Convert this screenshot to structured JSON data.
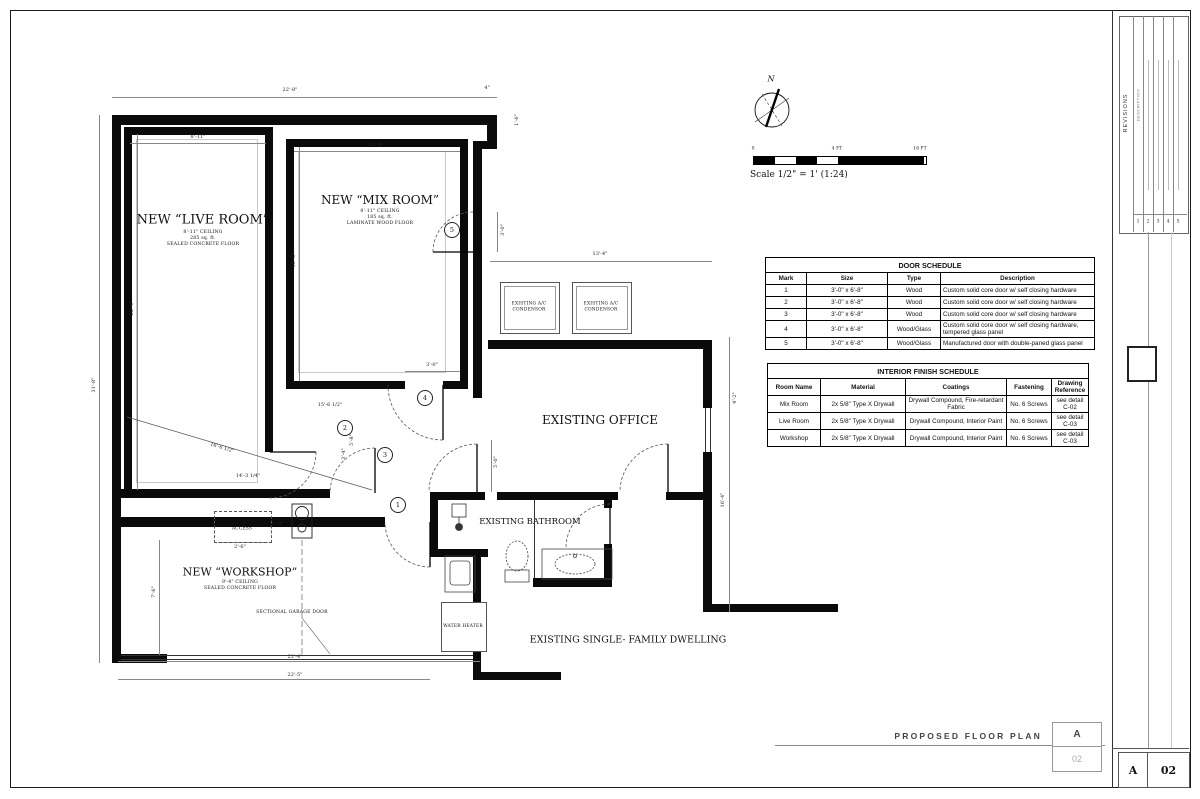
{
  "sheet": {
    "drawing_title": "PROPOSED FLOOR PLAN",
    "title_box": {
      "letter": "A",
      "number": "02"
    },
    "corner_box": {
      "letter": "A",
      "number": "02"
    },
    "north_label": "N",
    "scale_note": "Scale 1/2\" = 1' (1:24)",
    "scale_ticks": {
      "zero": "0",
      "mid": "4 FT",
      "end": "16 FT"
    }
  },
  "rooms": {
    "live": {
      "name": "NEW “LIVE ROOM”",
      "line1": "8'-11\" CEILING",
      "line2": "285 sq. ft.",
      "line3": "SEALED CONCRETE FLOOR"
    },
    "mix": {
      "name": "NEW “MIX ROOM”",
      "line1": "8'-11\" CEILING",
      "line2": "185 sq. ft.",
      "line3": "LAMINATE WOOD FLOOR"
    },
    "workshop": {
      "name": "NEW “WORKSHOP”",
      "line1": "9'-4\" CEILING",
      "line2": "SEALED CONCRETE FLOOR"
    },
    "office": "EXISTING OFFICE",
    "bathroom": "EXISTING BATHROOM",
    "dwelling": "EXISTING SINGLE- FAMILY DWELLING"
  },
  "equipment": {
    "ac1": "EXISTING A/C CONDENSOR",
    "ac2": "EXISTING A/C CONDENSOR",
    "water_heater": "WATER HEATER",
    "attic": "NEW ATTIC ACCESS",
    "garage_door": "SECTIONAL GARAGE DOOR"
  },
  "door_tags": [
    "1",
    "2",
    "3",
    "4",
    "5"
  ],
  "dims": {
    "overall_top": "22'-8\"",
    "jog": "4\"",
    "jog_side": "1'-6\"",
    "live_width": "8'-11\"",
    "mix_width": "13'-0\"",
    "overall_left": "31'-8\"",
    "live_height": "22'-4\"",
    "mix_height": "15'-6\"",
    "workshop_left": "7'-6\"",
    "office_top": "13'-4\"",
    "right_upper": "4'-2\"",
    "right_lower": "16'-4\"",
    "door4": "3'-0\"",
    "door5": "3'-0\"",
    "hall": "5'-0\"",
    "diagonal": "16'-6 1/2\"",
    "interior_a": "15'-6 1/2\"",
    "interior_b": "14'-3 1/4\"",
    "door2_a": "5'-8\"",
    "door2_b": "3'-4\"",
    "attic_width": "2'-6\"",
    "attic_offset": "10'-0\"",
    "overall_bottom": "22'-4\"",
    "garage_width": "22'-5\""
  },
  "door_schedule": {
    "title": "DOOR SCHEDULE",
    "headers": [
      "Mark",
      "Size",
      "Type",
      "Description"
    ],
    "rows": [
      [
        "1",
        "3'-0\" x 6'-8\"",
        "Wood",
        "Custom solid core door w/ self closing hardware"
      ],
      [
        "2",
        "3'-0\" x 6'-8\"",
        "Wood",
        "Custom solid core door w/ self closing hardware"
      ],
      [
        "3",
        "3'-0\" x 6'-8\"",
        "Wood",
        "Custom solid core door w/ self closing hardware"
      ],
      [
        "4",
        "3'-0\" x 6'-8\"",
        "Wood/Glass",
        "Custom solid core door w/ self closing hardware, tempered glass panel"
      ],
      [
        "5",
        "3'-0\" x 6'-8\"",
        "Wood/Glass",
        "Manufactured door with double-paned glass panel"
      ]
    ]
  },
  "finish_schedule": {
    "title": "INTERIOR FINISH SCHEDULE",
    "headers": [
      "Room Name",
      "Material",
      "Coatings",
      "Fastening",
      "Drawing Reference"
    ],
    "rows": [
      [
        "Mix Room",
        "2x 5/8\" Type X Drywall",
        "Drywall Compound, Fire-retardant Fabric",
        "No. 6 Screws",
        "see detail C-02"
      ],
      [
        "Live Room",
        "2x 5/8\" Type X Drywall",
        "Drywall Compound, Interior Paint",
        "No. 6 Screws",
        "see detail C-03"
      ],
      [
        "Workshop",
        "2x 5/8\" Type X Drywall",
        "Drywall Compound, Interior Paint",
        "No. 6 Screws",
        "see detail C-03"
      ]
    ]
  },
  "title_strip": {
    "revisions": "REVISIONS",
    "description": "DESCRIPTION",
    "row_numbers": [
      "1",
      "2",
      "3",
      "4",
      "5"
    ],
    "logo": "TLA"
  }
}
